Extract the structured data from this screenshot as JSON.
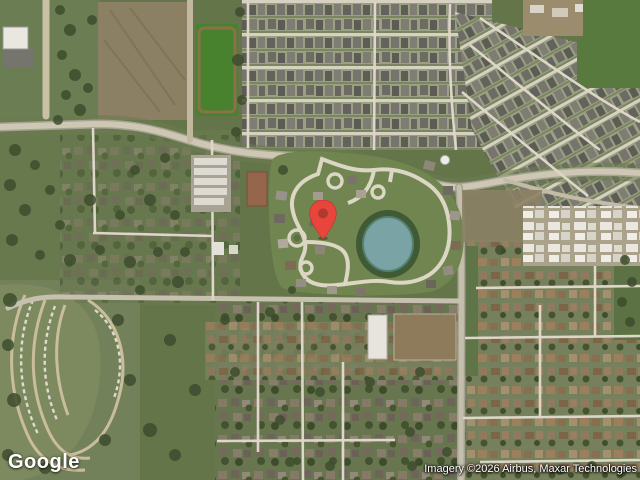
{
  "map": {
    "provider_logo": "Google",
    "attribution": "Imagery ©2026 Airbus, Maxar Technologies",
    "marker": {
      "kind": "red-location-pin",
      "color": "#E8453C",
      "inner_dot_color": "#B03A2E",
      "tip_x": 323,
      "tip_y": 239
    },
    "colors": {
      "vegetation_green": "#637549",
      "lawn_green": "#71854f",
      "tree_green": "#3e4d2e",
      "scrub_field": "#8b8063",
      "road_main": "#c8c2b0",
      "street_light": "#dcd7c7",
      "rooftop_gray": "#6e6c63",
      "rooftop_brown": "#8f7a5f",
      "pond_teal": "#7aa3a6"
    }
  }
}
